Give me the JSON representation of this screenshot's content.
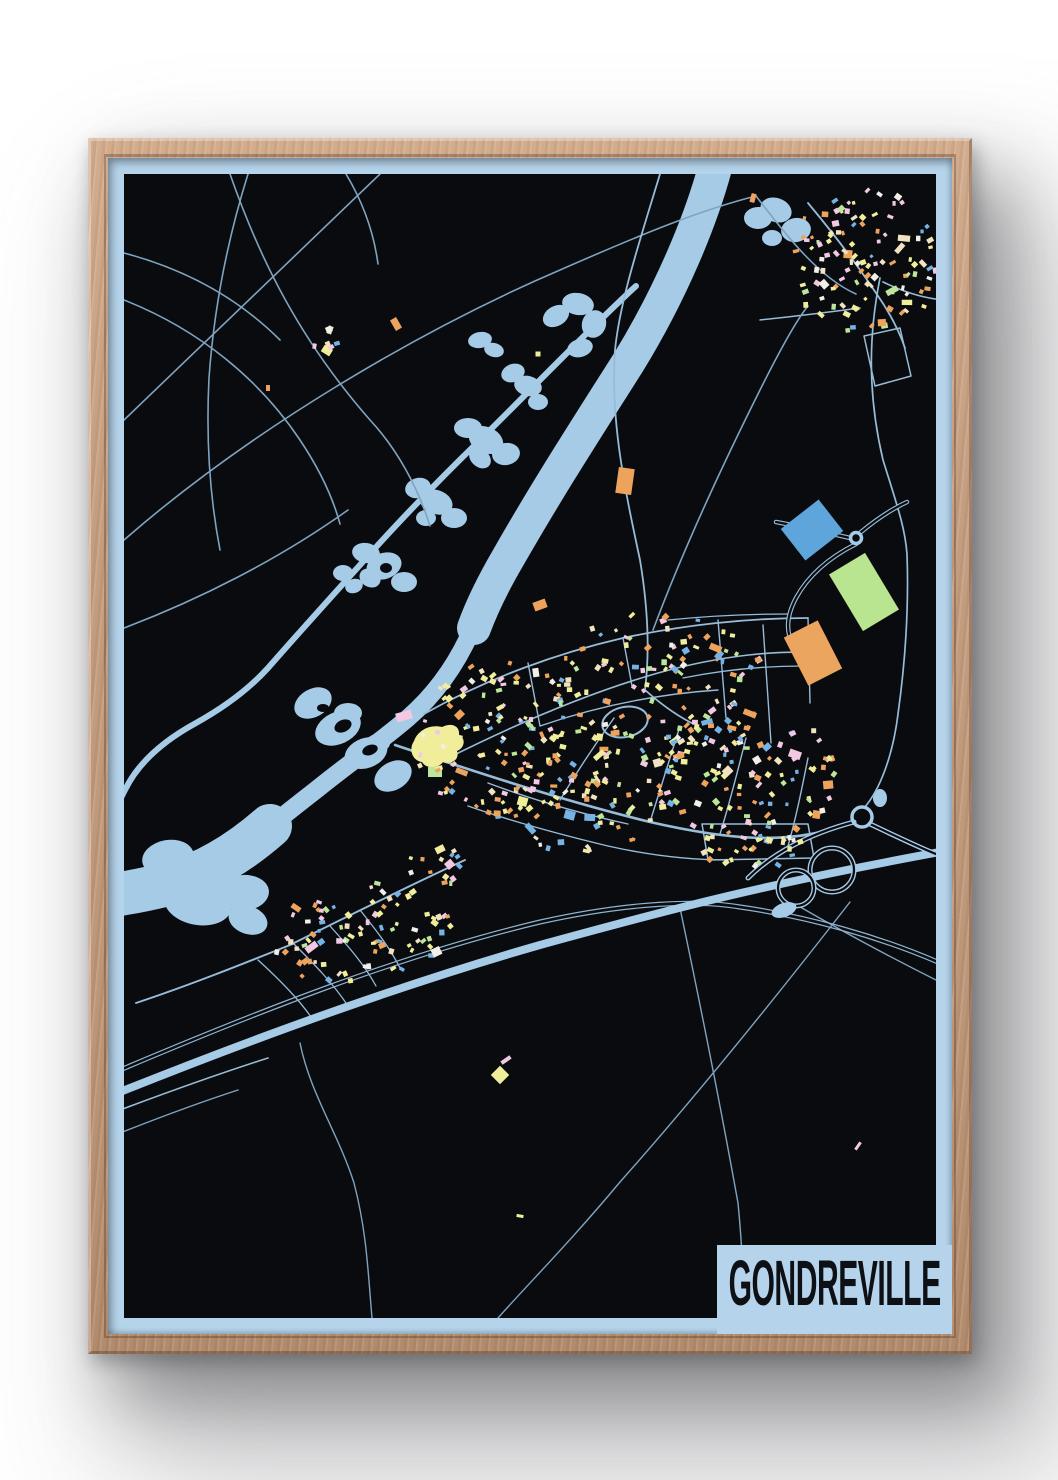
{
  "poster": {
    "title": "GONDREVILLE",
    "colors": {
      "wall": "#ffffff",
      "frame_wood": "#c59e80",
      "margin_blue": "#b5d4eb",
      "background": "#0a0b0f",
      "water": "#a6cbe7",
      "road_thin": "#7fa4c0",
      "road_med": "#96bcd8",
      "motorway": "#a6cbe7",
      "rail": "#8fb3cf",
      "title_text": "#0d1014"
    }
  },
  "map": {
    "view": [
      844,
      1176
    ],
    "map_rect": [
      16,
      16,
      812,
      1144
    ],
    "palette": [
      [
        "#f0ee9b",
        26
      ],
      [
        "#eea35d",
        22
      ],
      [
        "#f2e3c0",
        12
      ],
      [
        "#f3c8e2",
        12
      ],
      [
        "#74b3e4",
        12
      ],
      [
        "#bce79a",
        10
      ],
      [
        "#f2efe9",
        6
      ]
    ],
    "rivers": [
      {
        "d": "M 612,-10 C 596,60 560,140 520,205 C 480,268 440,330 400,400 C 386,424 374,448 366,470",
        "w": 34
      },
      {
        "d": "M 368,462 C 352,502 330,534 300,560 C 272,584 240,606 208,632 C 190,646 172,660 158,672",
        "w": 18
      },
      {
        "d": "M 162,668 C 130,696 96,716 60,726 C 40,731 18,736 -6,738",
        "w": 44
      },
      {
        "d": "M 528,128 C 480,172 420,235 372,282 C 330,323 290,364 252,407 C 225,437 195,470 160,510 C 140,532 115,550 88,565 C 55,583 30,605 17,632 C 10,646 5,655 -5,660",
        "w": 6
      }
    ],
    "lakes": [
      {
        "name": "chain-1",
        "parts": [
          [
            448,
            158,
            14,
            10,
            -30
          ],
          [
            470,
            146,
            16,
            11,
            10
          ],
          [
            486,
            166,
            12,
            14,
            20
          ],
          [
            472,
            190,
            13,
            9,
            -15
          ]
        ],
        "holes": [
          [
            466,
            168,
            7,
            6,
            0
          ]
        ]
      },
      {
        "name": "chain-2",
        "parts": [
          [
            405,
            215,
            12,
            9,
            -20
          ],
          [
            420,
            228,
            14,
            10,
            15
          ],
          [
            430,
            244,
            10,
            8,
            0
          ]
        ],
        "holes": []
      },
      {
        "name": "chain-3",
        "parts": [
          [
            360,
            270,
            14,
            10,
            0
          ],
          [
            378,
            282,
            18,
            13,
            25
          ],
          [
            398,
            296,
            14,
            11,
            -10
          ],
          [
            372,
            300,
            12,
            9,
            40
          ]
        ],
        "holes": []
      },
      {
        "name": "chain-4",
        "parts": [
          [
            310,
            330,
            13,
            10,
            -15
          ],
          [
            328,
            344,
            17,
            12,
            20
          ],
          [
            346,
            360,
            13,
            10,
            0
          ],
          [
            318,
            360,
            10,
            8,
            0
          ]
        ],
        "holes": []
      },
      {
        "name": "chain-5",
        "parts": [
          [
            258,
            395,
            14,
            10,
            10
          ],
          [
            276,
            408,
            18,
            13,
            -20
          ],
          [
            296,
            424,
            13,
            10,
            0
          ],
          [
            262,
            420,
            11,
            9,
            30
          ]
        ],
        "holes": [
          [
            278,
            410,
            6,
            5,
            0
          ]
        ]
      },
      {
        "name": "chain-6",
        "parts": [
          [
            235,
            415,
            10,
            8,
            0
          ],
          [
            246,
            428,
            9,
            7,
            -20
          ]
        ],
        "holes": []
      },
      {
        "name": "chain-7",
        "parts": [
          [
            372,
            182,
            12,
            8,
            -10
          ],
          [
            386,
            192,
            10,
            7,
            15
          ]
        ],
        "holes": []
      },
      {
        "name": "ponds-ne",
        "parts": [
          [
            650,
            60,
            14,
            11,
            0
          ],
          [
            668,
            52,
            16,
            12,
            20
          ],
          [
            688,
            72,
            15,
            12,
            -10
          ],
          [
            664,
            80,
            10,
            8,
            0
          ]
        ],
        "holes": []
      },
      {
        "name": "pond-east",
        "parts": [
          [
            772,
            640,
            7,
            9,
            0
          ]
        ],
        "holes": []
      },
      {
        "name": "braid",
        "parts": [
          [
            205,
            545,
            20,
            14,
            -30
          ],
          [
            230,
            570,
            24,
            16,
            -25
          ],
          [
            258,
            595,
            22,
            15,
            -20
          ],
          [
            285,
            618,
            20,
            14,
            -30
          ],
          [
            240,
            555,
            14,
            10,
            0
          ],
          [
            270,
            585,
            12,
            9,
            0
          ]
        ],
        "holes": [
          [
            235,
            568,
            9,
            6,
            -25
          ],
          [
            262,
            592,
            8,
            5,
            -20
          ],
          [
            215,
            550,
            6,
            4,
            0
          ]
        ]
      },
      {
        "name": "exit-loop",
        "parts": [
          [
            60,
            700,
            26,
            18,
            -10
          ],
          [
            95,
            715,
            30,
            20,
            15
          ],
          [
            135,
            735,
            26,
            18,
            -5
          ],
          [
            90,
            745,
            34,
            22,
            10
          ],
          [
            50,
            730,
            22,
            16,
            0
          ],
          [
            140,
            762,
            20,
            14,
            20
          ]
        ],
        "holes": []
      }
    ],
    "roads": [
      {
        "d": "M 16,262 L 272,16",
        "w": 1.6,
        "k": "thin"
      },
      {
        "d": "M 16,382 C 142,272 312,172 452,112 C 532,77 592,52 648,38",
        "w": 1.6,
        "k": "thin"
      },
      {
        "d": "M 122,16 C 152,102 192,182 262,262 C 290,292 310,330 322,368",
        "w": 1.6,
        "k": "thin"
      },
      {
        "d": "M 16,142 C 92,172 152,222 192,282 C 212,312 225,340 232,366",
        "w": 1.6,
        "k": "thin"
      },
      {
        "d": "M 140,16 C 120,80 106,150 101,220 C 98,280 102,340 112,392",
        "w": 1.6,
        "k": "thin"
      },
      {
        "d": "M 16,470 C 90,442 170,402 240,352",
        "w": 1.6,
        "k": "thin"
      },
      {
        "d": "M 16,95 C 80,112 132,142 172,182",
        "w": 1.6,
        "k": "thin"
      },
      {
        "d": "M 238,16 C 256,46 266,76 270,106",
        "w": 1.6,
        "k": "thin"
      },
      {
        "d": "M 552,16 C 532,82 512,142 507,192 C 502,262 517,332 532,402 C 540,450 542,492 537,532",
        "w": 1.8,
        "k": "med"
      },
      {
        "d": "M 648,38 C 680,80 712,120 748,136",
        "w": 1.6,
        "k": "thin"
      },
      {
        "d": "M 772,120 C 762,170 758,230 775,302 C 790,350 797,370 799,396 C 801,452 797,506 790,556 C 785,597 772,632 756,650",
        "w": 1.7,
        "k": "med"
      },
      {
        "d": "M 700,45 C 725,75 748,105 768,135 C 780,152 790,170 797,190",
        "w": 1.8,
        "k": "med"
      },
      {
        "d": "M 836,142 C 812,140 792,132 775,124",
        "w": 1.6,
        "k": "med"
      },
      {
        "d": "M 756,178 L 792,170 L 803,218 L 767,228 Z",
        "w": 1.5,
        "k": "med"
      },
      {
        "d": "M 652,162 C 690,158 722,154 752,150",
        "w": 1.5,
        "k": "med"
      },
      {
        "d": "M 537,532 C 555,548 572,560 590,568",
        "w": 1.8,
        "k": "med"
      },
      {
        "d": "M 287,587 C 362,612 452,642 542,664 C 612,680 682,690 744,664",
        "w": 2.6,
        "k": "med"
      },
      {
        "d": "M 545,472 C 575,392 612,312 652,232 C 672,192 690,160 700,148",
        "w": 1.6,
        "k": "thin"
      },
      {
        "d": "M 316,556 C 380,520 450,495 515,480 C 575,467 640,460 700,460",
        "w": 1.8,
        "k": "med"
      },
      {
        "d": "M 340,600 C 410,565 480,535 550,515 C 615,497 670,492 710,495",
        "w": 1.6,
        "k": "med"
      },
      {
        "d": "M 420,505 L 432,568",
        "w": 1.4,
        "k": "med"
      },
      {
        "d": "M 515,480 L 524,528",
        "w": 1.4,
        "k": "med"
      },
      {
        "d": "M 610,462 L 618,560",
        "w": 1.4,
        "k": "med"
      },
      {
        "d": "M 700,460 L 702,545",
        "w": 1.4,
        "k": "med"
      },
      {
        "d": "M 655,467 L 663,585",
        "w": 1.4,
        "k": "med"
      },
      {
        "d": "M 560,462 C 600,458 640,456 680,456",
        "w": 1.3,
        "k": "med"
      },
      {
        "d": "M 575,520 C 615,512 655,508 695,508",
        "w": 1.3,
        "k": "med"
      },
      {
        "d": "M 432,568 C 490,548 550,536 610,532",
        "w": 1.4,
        "k": "med"
      },
      {
        "d": "M 452,642 C 470,612 488,585 506,560",
        "w": 1.4,
        "k": "med"
      },
      {
        "d": "M 542,664 C 552,632 562,600 572,568",
        "w": 1.4,
        "k": "med"
      },
      {
        "d": "M 612,676 C 622,644 630,612 638,580",
        "w": 1.4,
        "k": "med"
      },
      {
        "d": "M 680,688 C 688,660 694,630 700,600",
        "w": 1.4,
        "k": "med"
      },
      {
        "d": "M 380,625 C 420,640 470,655 520,666",
        "w": 1.4,
        "k": "med"
      },
      {
        "d": "M 360,648 C 400,662 450,676 500,688 C 540,697 580,702 620,702",
        "w": 1.4,
        "k": "med"
      },
      {
        "d": "M 594,666 L 700,666 L 706,700 L 600,702 Z",
        "w": 1.5,
        "k": "med"
      },
      {
        "d": "M 357,702 C 292,732 232,762 182,787 C 132,807 82,827 28,845",
        "w": 1.9,
        "k": "med"
      },
      {
        "d": "M 185,785 C 205,805 225,825 240,848",
        "w": 1.3,
        "k": "med"
      },
      {
        "d": "M 222,768 C 240,788 256,806 268,828",
        "w": 1.3,
        "k": "med"
      },
      {
        "d": "M 252,752 C 268,772 282,790 292,810",
        "w": 1.3,
        "k": "med"
      },
      {
        "d": "M 150,802 C 172,822 192,842 205,862",
        "w": 1.3,
        "k": "med"
      },
      {
        "d": "M 192,885 C 202,935 230,975 246,1025 C 259,1075 260,1115 264,1160",
        "w": 1.4,
        "k": "thin"
      },
      {
        "d": "M 742,744 C 672,834 592,934 512,1024 C 462,1084 422,1124 390,1160",
        "w": 1.4,
        "k": "thin"
      },
      {
        "d": "M 572,750 C 592,845 612,945 630,1045 C 636,1105 635,1135 637,1160",
        "w": 1.4,
        "k": "thin"
      },
      {
        "d": "M 687,746 C 732,772 782,799 828,822",
        "w": 1.4,
        "k": "thin"
      },
      {
        "d": "M 12,952 C 60,934 110,916 160,900",
        "w": 1.6,
        "k": "med"
      },
      {
        "d": "M 12,975 C 50,960 90,945 130,932",
        "w": 1.4,
        "k": "thin"
      },
      {
        "d": "M 742,380 C 716,374 690,368 668,364",
        "w": 1.5,
        "k": "outlined"
      },
      {
        "d": "M 748,386 C 720,400 700,418 688,440 C 680,455 678,468 682,480",
        "w": 1.5,
        "k": "outlined"
      },
      {
        "d": "M 753,374 C 770,360 786,350 799,344",
        "w": 1.5,
        "k": "outlined"
      }
    ],
    "motorway": {
      "main": {
        "d": "M 12,934 C 142,882 292,827 432,787 C 552,754 652,727 832,694",
        "w": 8
      },
      "ramps": [
        {
          "d": "M 746,664 C 700,676 664,696 640,720"
        },
        {
          "d": "M 762,666 C 792,680 816,692 838,700"
        }
      ],
      "loops": [
        [
          724,
          712,
          22
        ],
        [
          688,
          730,
          18
        ]
      ],
      "roundabouts": [
        [
          754,
          659,
          10
        ],
        [
          748,
          380,
          5.5
        ]
      ],
      "teardrop": [
        676,
        752,
        13,
        7,
        -20
      ]
    },
    "railway": [
      {
        "d": "M 12,910 C 142,855 292,795 432,762 C 522,742 592,740 632,747 C 702,757 772,777 832,803"
      },
      {
        "d": "M 12,914 C 142,859 292,799 432,766 C 522,746 592,744 632,751 C 702,761 772,781 832,807"
      }
    ],
    "big_buildings": [
      {
        "x": 704,
        "y": 372,
        "w": 48,
        "h": 40,
        "r": -38,
        "c": "#5ea5db"
      },
      {
        "x": 756,
        "y": 434,
        "w": 42,
        "h": 66,
        "r": -31,
        "c": "#b9e490"
      },
      {
        "x": 705,
        "y": 495,
        "w": 38,
        "h": 54,
        "r": -27,
        "c": "#eca55e"
      },
      {
        "x": 517,
        "y": 323,
        "w": 16,
        "h": 26,
        "r": 8,
        "c": "#eea35d"
      },
      {
        "x": 432,
        "y": 447,
        "w": 13,
        "h": 9,
        "r": -20,
        "c": "#eea35d"
      },
      {
        "x": 296,
        "y": 558,
        "w": 16,
        "h": 9,
        "r": -15,
        "c": "#f3c8e2"
      },
      {
        "x": 327,
        "y": 614,
        "w": 14,
        "h": 10,
        "r": 0,
        "c": "#bce79a"
      }
    ],
    "chateau": {
      "d": "M 306,583 C 310,572 322,566 334,569 C 344,564 352,568 351,577 C 358,580 357,590 349,593 C 352,601 344,607 335,604 C 330,611 318,611 314,604 C 305,603 300,592 306,583 Z",
      "c": "#f0ee9b"
    },
    "stadium": {
      "cx": 517,
      "cy": 564,
      "rx": 23,
      "ry": 15,
      "rot": -12
    },
    "clusters": [
      {
        "cx": 397,
        "cy": 587,
        "rx": 88,
        "ry": 85,
        "n": 120,
        "seed": 11
      },
      {
        "cx": 552,
        "cy": 532,
        "rx": 110,
        "ry": 78,
        "n": 130,
        "seed": 22
      },
      {
        "cx": 637,
        "cy": 617,
        "rx": 95,
        "ry": 68,
        "n": 105,
        "seed": 33
      },
      {
        "cx": 472,
        "cy": 642,
        "rx": 90,
        "ry": 52,
        "n": 70,
        "seed": 44
      },
      {
        "cx": 642,
        "cy": 687,
        "rx": 52,
        "ry": 24,
        "n": 26,
        "seed": 55
      },
      {
        "cx": 757,
        "cy": 104,
        "rx": 78,
        "ry": 72,
        "n": 110,
        "seed": 66
      },
      {
        "cx": 255,
        "cy": 777,
        "rx": 92,
        "ry": 55,
        "n": 85,
        "seed": 77
      },
      {
        "cx": 332,
        "cy": 707,
        "rx": 32,
        "ry": 20,
        "n": 16,
        "seed": 88
      },
      {
        "cx": 220,
        "cy": 180,
        "rx": 18,
        "ry": 14,
        "n": 6,
        "seed": 99
      }
    ],
    "singles": [
      {
        "x": 288,
        "y": 166,
        "w": 7,
        "h": 12,
        "r": -30,
        "c": "#eea35d"
      },
      {
        "x": 222,
        "y": 172,
        "w": 5,
        "h": 8,
        "r": 20,
        "c": "#f2e3c0"
      },
      {
        "x": 160,
        "y": 230,
        "w": 4,
        "h": 6,
        "r": 0,
        "c": "#eea35d"
      },
      {
        "x": 430,
        "y": 196,
        "w": 5,
        "h": 5,
        "r": 0,
        "c": "#f0ee9b"
      },
      {
        "x": 645,
        "y": 40,
        "w": 5,
        "h": 9,
        "r": 15,
        "c": "#eea35d"
      },
      {
        "x": 392,
        "y": 917,
        "w": 13,
        "h": 13,
        "r": 45,
        "c": "#f0ee9b"
      },
      {
        "x": 398,
        "y": 902,
        "w": 11,
        "h": 4,
        "r": -35,
        "c": "#f3c8e2"
      },
      {
        "x": 412,
        "y": 1058,
        "w": 7,
        "h": 3,
        "r": 10,
        "c": "#f0ee9b"
      },
      {
        "x": 750,
        "y": 988,
        "w": 9,
        "h": 3,
        "r": -55,
        "c": "#f3c8e2"
      }
    ]
  }
}
